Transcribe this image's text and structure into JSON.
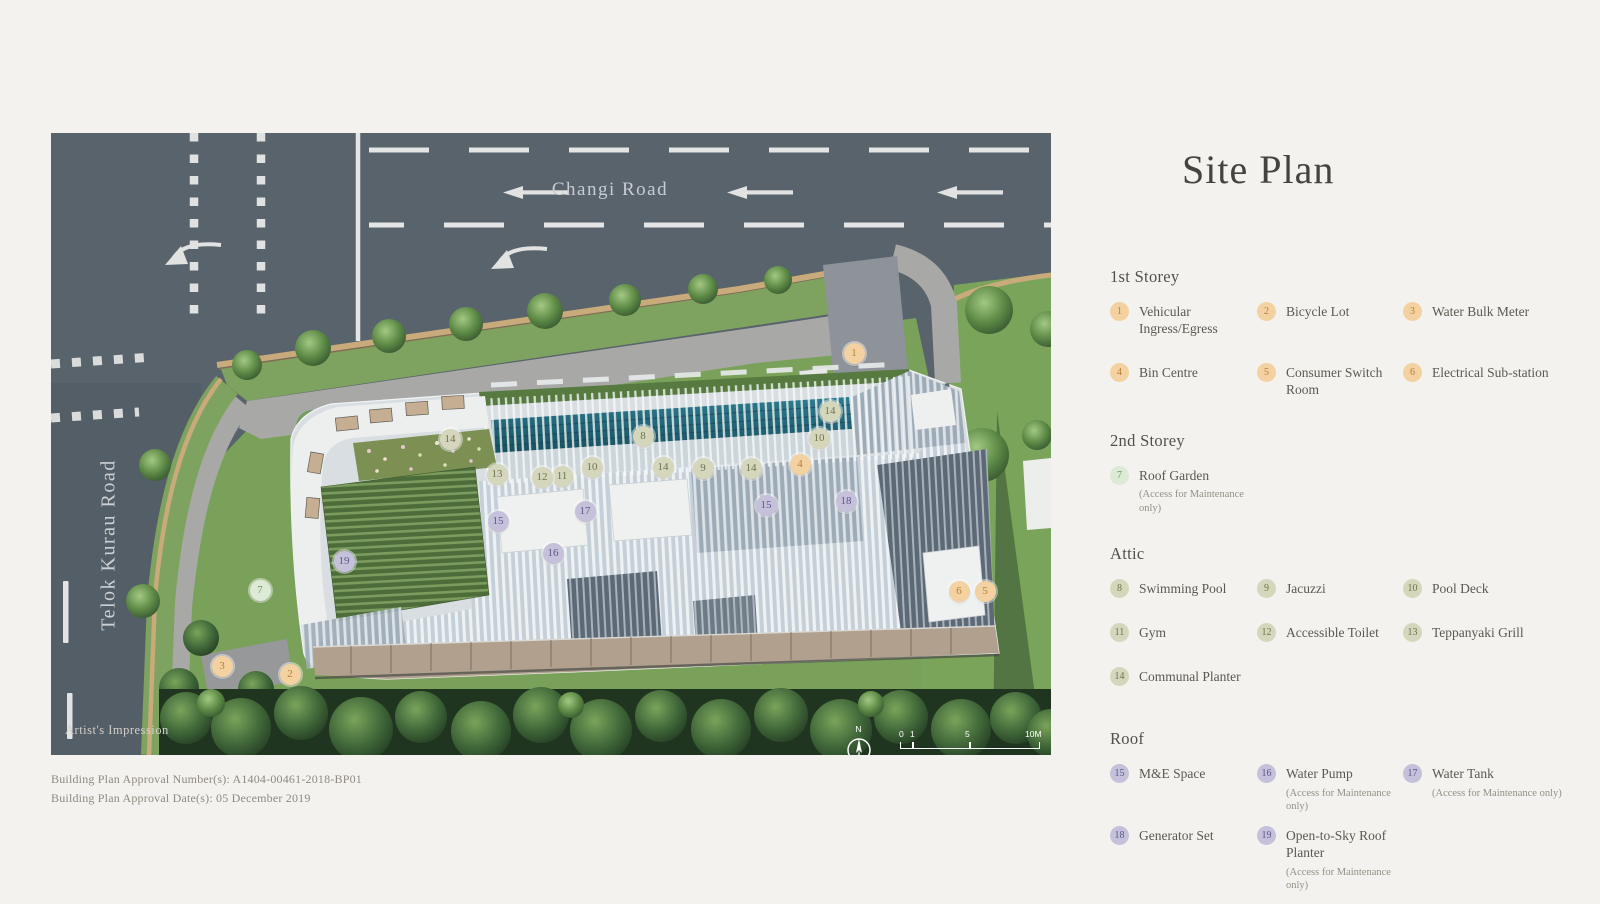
{
  "plan": {
    "roads": {
      "changi": "Changi Road",
      "telok": "Telok Kurau Road"
    },
    "note": "Artist's Impression",
    "compass_label": "N",
    "scale_labels": [
      "0",
      "1",
      "5",
      "10M"
    ],
    "markers": [
      {
        "n": "1",
        "x": 803,
        "y": 220,
        "t": "storey1"
      },
      {
        "n": "2",
        "x": 239,
        "y": 541,
        "t": "storey1"
      },
      {
        "n": "3",
        "x": 171,
        "y": 533,
        "t": "storey1"
      },
      {
        "n": "4",
        "x": 749,
        "y": 331,
        "t": "storey1"
      },
      {
        "n": "5",
        "x": 934,
        "y": 458,
        "t": "storey1"
      },
      {
        "n": "6",
        "x": 908,
        "y": 458,
        "t": "storey1"
      },
      {
        "n": "7",
        "x": 209,
        "y": 457,
        "t": "storey2"
      },
      {
        "n": "8",
        "x": 592,
        "y": 303,
        "t": "attic"
      },
      {
        "n": "9",
        "x": 652,
        "y": 335,
        "t": "attic"
      },
      {
        "n": "10",
        "x": 541,
        "y": 334,
        "t": "attic"
      },
      {
        "n": "10",
        "x": 768,
        "y": 305,
        "t": "attic"
      },
      {
        "n": "11",
        "x": 511,
        "y": 343,
        "t": "attic"
      },
      {
        "n": "12",
        "x": 491,
        "y": 344,
        "t": "attic"
      },
      {
        "n": "13",
        "x": 446,
        "y": 341,
        "t": "attic"
      },
      {
        "n": "14",
        "x": 399,
        "y": 306,
        "t": "attic"
      },
      {
        "n": "14",
        "x": 779,
        "y": 278,
        "t": "attic"
      },
      {
        "n": "14",
        "x": 612,
        "y": 334,
        "t": "attic"
      },
      {
        "n": "14",
        "x": 700,
        "y": 335,
        "t": "attic"
      },
      {
        "n": "15",
        "x": 447,
        "y": 388,
        "t": "roof"
      },
      {
        "n": "15",
        "x": 715,
        "y": 372,
        "t": "roof"
      },
      {
        "n": "16",
        "x": 502,
        "y": 420,
        "t": "roof"
      },
      {
        "n": "17",
        "x": 534,
        "y": 378,
        "t": "roof"
      },
      {
        "n": "18",
        "x": 795,
        "y": 368,
        "t": "roof"
      },
      {
        "n": "19",
        "x": 293,
        "y": 428,
        "t": "roof"
      }
    ]
  },
  "colors": {
    "storey1": {
      "bg": "#f3d1a0",
      "fg": "#b5813a"
    },
    "storey2": {
      "bg": "#dcead6",
      "fg": "#699a64"
    },
    "attic": {
      "bg": "#d4d7bb",
      "fg": "#6e744e"
    },
    "roof": {
      "bg": "#c5c1da",
      "fg": "#5d5887"
    }
  },
  "legend": {
    "title": "Site Plan",
    "sections": [
      {
        "id": "1st-storey",
        "name": "1st Storey",
        "color": "storey1",
        "items": [
          {
            "num": "1",
            "label": "Vehicular Ingress/Egress"
          },
          {
            "num": "2",
            "label": "Bicycle Lot"
          },
          {
            "num": "3",
            "label": "Water Bulk Meter"
          },
          {
            "num": "4",
            "label": "Bin Centre"
          },
          {
            "num": "5",
            "label": "Consumer Switch Room"
          },
          {
            "num": "6",
            "label": "Electrical Sub-station"
          }
        ]
      },
      {
        "id": "2nd-storey",
        "name": "2nd Storey",
        "color": "storey2",
        "items": [
          {
            "num": "7",
            "label": "Roof Garden",
            "note": "(Access for Maintenance only)"
          }
        ]
      },
      {
        "id": "attic",
        "name": "Attic",
        "color": "attic",
        "items": [
          {
            "num": "8",
            "label": "Swimming Pool"
          },
          {
            "num": "9",
            "label": "Jacuzzi"
          },
          {
            "num": "10",
            "label": "Pool Deck"
          },
          {
            "num": "11",
            "label": "Gym"
          },
          {
            "num": "12",
            "label": "Accessible Toilet"
          },
          {
            "num": "13",
            "label": "Teppanyaki Grill"
          },
          {
            "num": "14",
            "label": "Communal Planter"
          }
        ]
      },
      {
        "id": "roof",
        "name": "Roof",
        "color": "roof",
        "items": [
          {
            "num": "15",
            "label": "M&E Space"
          },
          {
            "num": "16",
            "label": "Water Pump",
            "note": "(Access for Maintenance only)"
          },
          {
            "num": "17",
            "label": "Water Tank",
            "note": "(Access for Maintenance only)"
          },
          {
            "num": "18",
            "label": "Generator Set"
          },
          {
            "num": "19",
            "label": "Open-to-Sky Roof Planter",
            "note": "(Access for Maintenance only)"
          }
        ]
      }
    ]
  },
  "footer": {
    "line1": "Building Plan Approval Number(s): A1404-00461-2018-BP01",
    "line2": "Building Plan Approval Date(s): 05 December 2019"
  }
}
